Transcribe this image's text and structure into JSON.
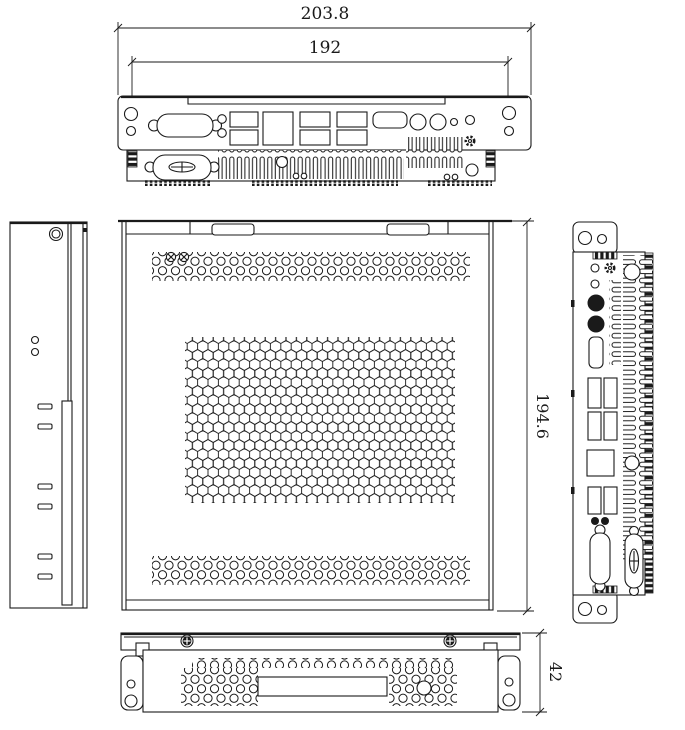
{
  "drawing": {
    "dimensions": {
      "overall_width": "203.8",
      "mounting_span": "192",
      "depth": "194.6",
      "height": "42"
    },
    "colors": {
      "line": "#1a1a1a",
      "background": "#ffffff"
    }
  }
}
